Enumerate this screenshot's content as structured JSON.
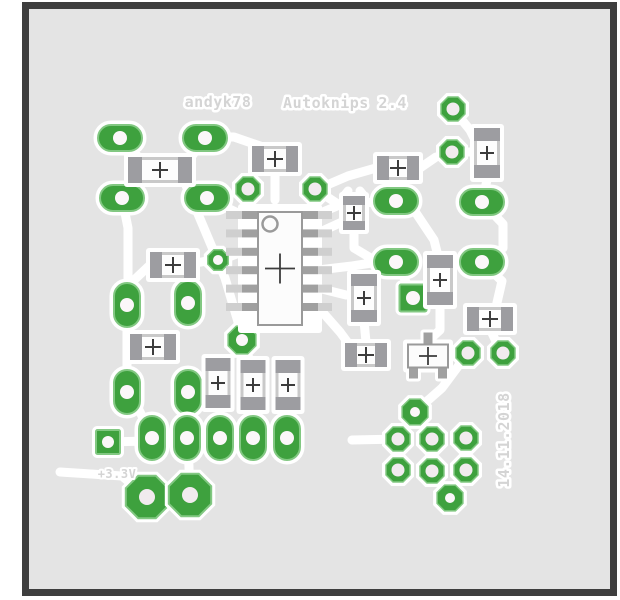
{
  "texts": {
    "author": "andyk78",
    "title": "Autoknips 2.4",
    "voltage": "+3.3V",
    "date": "14.11.2018"
  },
  "colors": {
    "page": "#ffffff",
    "board": "#e4e4e4",
    "frame": "#3e3e3e",
    "trace": "#ffffff",
    "pad_green": "#3ea13e",
    "pad_green_light": "#82c882",
    "hole": "#fbf7f9",
    "ring_hole": "#f1ebee",
    "smd_body": "#c9c9c9",
    "smd_cap": "#9d9da1",
    "smd_center": "#fdfdfd",
    "ic_body": "#fcfcfc",
    "ic_border": "#9a9a9a",
    "pin": "#a0a0a0",
    "pin_stub": "#cfcfcf",
    "cross": "#3c3c3c",
    "silk": "#d4d4d4"
  },
  "board": {
    "x": 25.5,
    "y": 5.5,
    "w": 588,
    "h": 587,
    "stroke_w": 7
  },
  "traces": [
    "M120 138 L150 169",
    "M205 138 L184 167",
    "M122 198 L128 228 L128 298",
    "M207 198 L238 213",
    "M182 176 L225 278 L241 332",
    "M266 148 L234 137 L212 137",
    "M275 172 L275 200",
    "M315 189 L344 208",
    "M354 228 L354 248 L374 260",
    "M318 233 L342 222",
    "M396 201 L342 204 L318 214",
    "M408 201 L434 240 L438 256",
    "M453 109 L470 130 L475 140",
    "M452 152 L472 152",
    "M482 202 L487 180",
    "M484 204 L503 224 L503 248 L486 260",
    "M376 168 L348 176 L320 188",
    "M420 168 L436 157",
    "M396 262 L410 290",
    "M318 270 L352 266 L378 262",
    "M318 288 L346 295",
    "M318 307 L340 332 L354 351",
    "M364 321 L366 342",
    "M440 305 L440 330 L428 341",
    "M484 264 L502 281 L496 307",
    "M468 353 L442 388 L417 410",
    "M500 350 L492 333",
    "M415 412 L399 436",
    "M432 440 L432 470",
    "M466 438 L466 469",
    "M433 472 L449 495",
    "M398 439 L352 440",
    "M108 442 L150 441",
    "M220 437 L220 410",
    "M253 437 L253 412",
    "M287 437 L287 412",
    "M187 438 L188 396",
    "M152 436 L133 398",
    "M147 497 L122 476 L60 472",
    "M190 493 L188 442",
    "M127 322 L127 375",
    "M150 265 L132 282",
    "M196 263 L212 260",
    "M242 252 L226 258",
    "M244 307 L242 330",
    "M250 360 L244 348",
    "M344 196 L348 191",
    "M360 191 L364 196"
  ],
  "pads": {
    "oval_h": [
      [
        120,
        138
      ],
      [
        205,
        138
      ],
      [
        122,
        198
      ],
      [
        207,
        198
      ],
      [
        396,
        201
      ],
      [
        482,
        202
      ],
      [
        396,
        262
      ],
      [
        482,
        262
      ]
    ],
    "oval_v": [
      [
        127,
        305
      ],
      [
        188,
        303
      ],
      [
        127,
        392
      ],
      [
        188,
        392
      ],
      [
        152,
        438
      ],
      [
        187,
        438
      ],
      [
        220,
        438
      ],
      [
        253,
        438
      ],
      [
        287,
        438
      ]
    ],
    "octagon_large": [
      [
        147,
        497
      ],
      [
        190,
        495
      ]
    ],
    "octagon_filled": [
      [
        218,
        260,
        11,
        5
      ],
      [
        242,
        340,
        15,
        6
      ],
      [
        415,
        412,
        14,
        5
      ],
      [
        450,
        498,
        14,
        5
      ]
    ],
    "ring": [
      [
        453,
        109
      ],
      [
        452,
        152
      ],
      [
        248,
        189
      ],
      [
        315,
        189
      ],
      [
        468,
        353
      ],
      [
        503,
        353
      ],
      [
        398,
        439
      ],
      [
        432,
        439
      ],
      [
        466,
        438
      ],
      [
        398,
        470
      ],
      [
        432,
        471
      ],
      [
        466,
        470
      ]
    ],
    "square": [
      [
        108,
        442,
        24,
        6
      ],
      [
        413,
        298,
        27,
        7
      ]
    ]
  },
  "components": {
    "smd_h": [
      [
        160,
        170,
        64,
        26
      ],
      [
        275,
        159,
        46,
        26
      ],
      [
        398,
        168,
        42,
        24
      ],
      [
        173,
        265,
        46,
        26
      ],
      [
        153,
        347,
        46,
        26
      ],
      [
        366,
        355,
        42,
        24
      ],
      [
        490,
        319,
        46,
        24
      ]
    ],
    "smd_v": [
      [
        354,
        213,
        22,
        34
      ],
      [
        364,
        298,
        26,
        48
      ],
      [
        440,
        280,
        26,
        50
      ],
      [
        487,
        153,
        26,
        50
      ],
      [
        218,
        383,
        25,
        50
      ],
      [
        253,
        385,
        25,
        50
      ],
      [
        288,
        385,
        25,
        50
      ]
    ],
    "sot23": {
      "cx": 428,
      "cy": 356,
      "bw": 40,
      "bh": 23
    },
    "ic": {
      "x": 258,
      "y": 212,
      "w": 44,
      "h": 113,
      "pins": 6,
      "pitch": 18.4,
      "pinStartY": 215
    }
  }
}
